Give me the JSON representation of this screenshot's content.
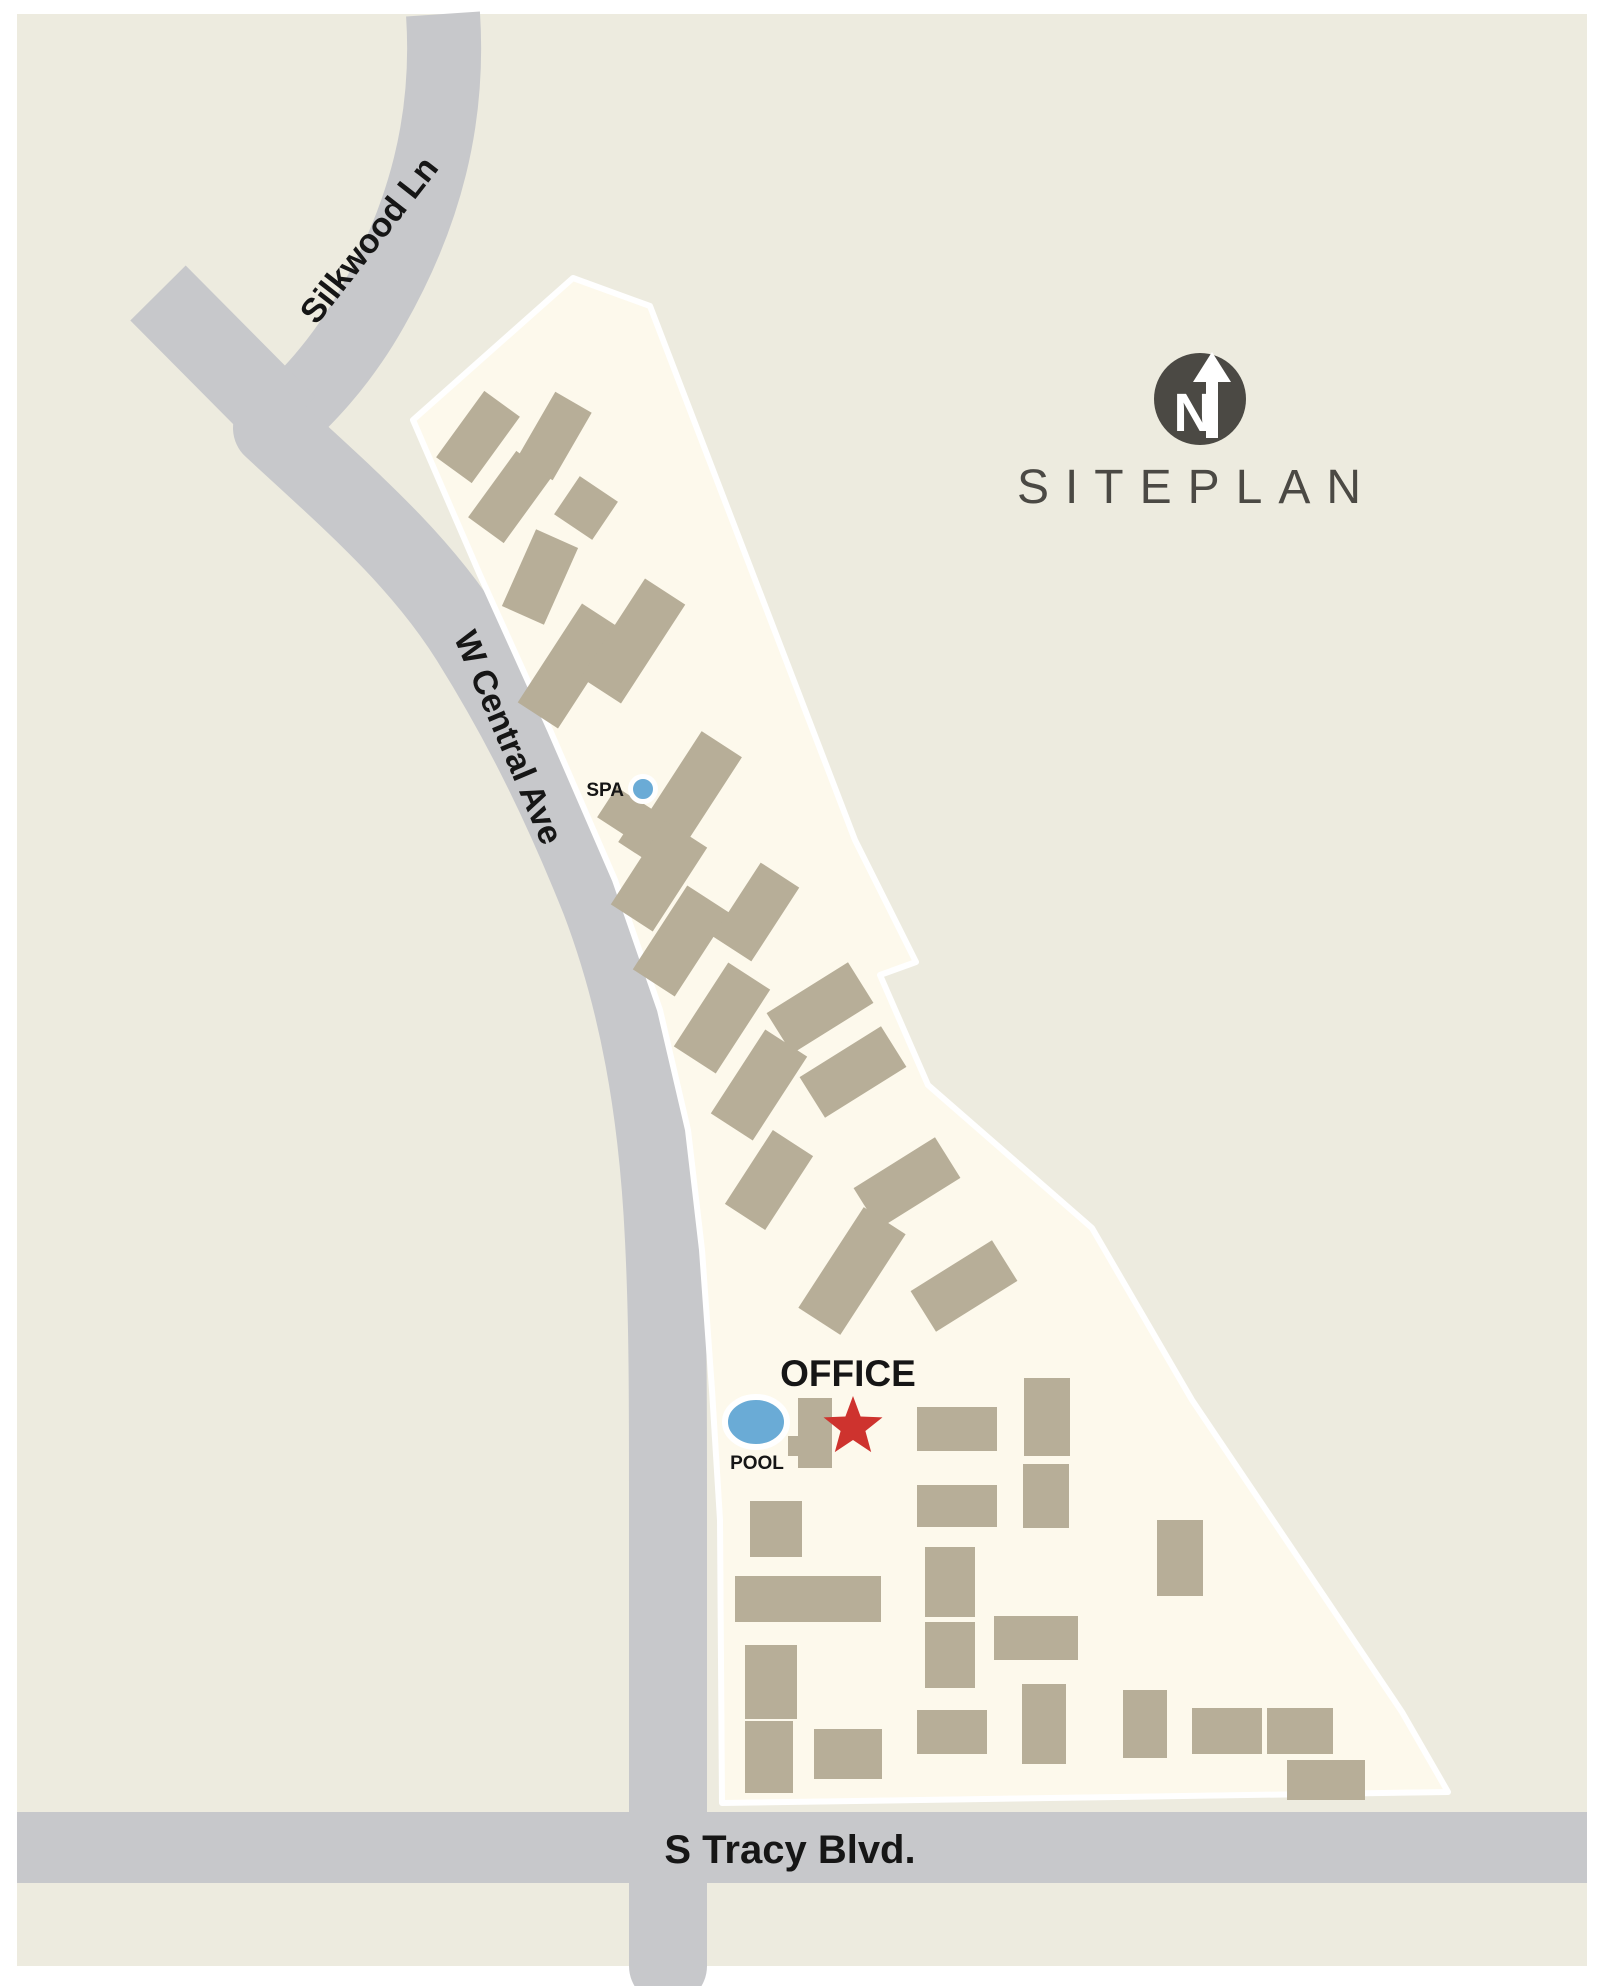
{
  "map": {
    "title": "SITEPLAN",
    "compass": {
      "letter": "N",
      "icon": "north-arrow-icon"
    },
    "streets": {
      "silkwood": "Silkwood Ln",
      "central": "W Central Ave",
      "tracy": "S Tracy Blvd."
    },
    "labels": {
      "office": "OFFICE",
      "pool": "POOL",
      "spa": "SPA"
    },
    "colors": {
      "page": "#ffffff",
      "background": "#edebdf",
      "site": "#fdf9ec",
      "site_border": "#ffffff",
      "road": "#c7c8cb",
      "building": "#b7ae98",
      "accent_red": "#ce332e",
      "water_blue": "#6aabd6",
      "ink_dark": "#4b4944",
      "text_black": "#161616"
    }
  }
}
